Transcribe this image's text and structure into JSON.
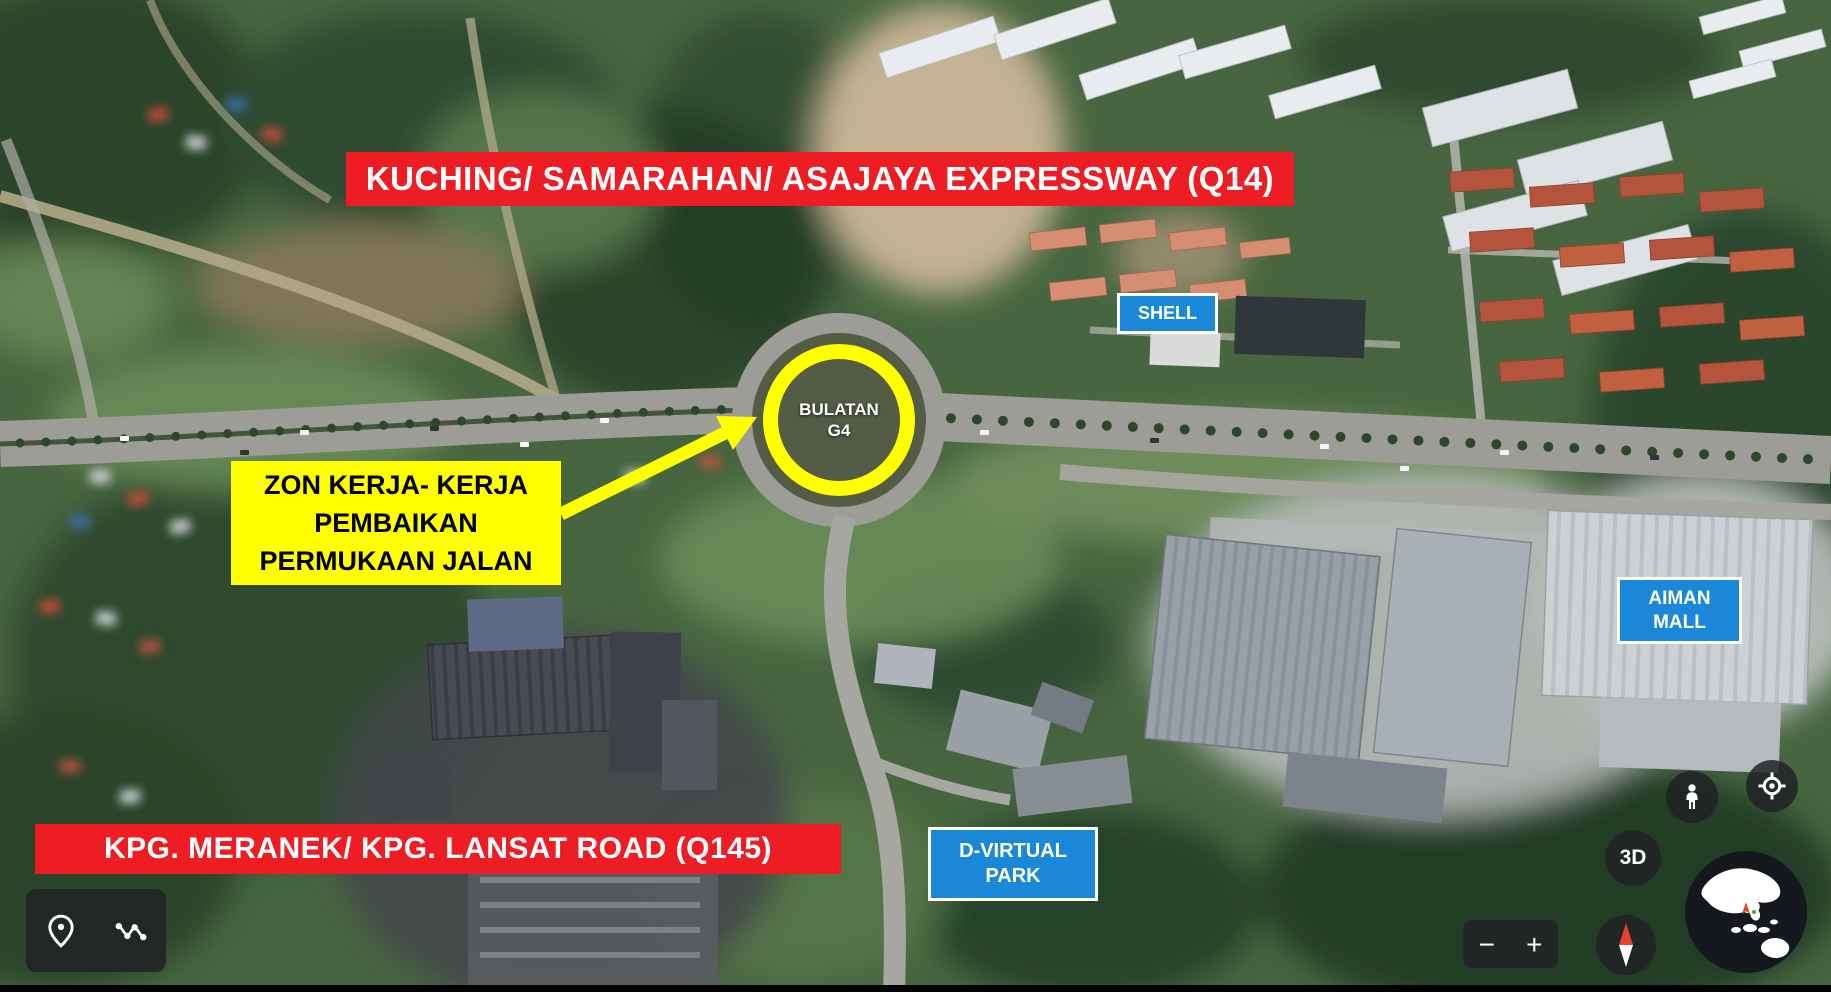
{
  "app": {
    "view": "satellite-map-with-roadwork-annotations"
  },
  "map_annotations": {
    "top_banner": "KUCHING/ SAMARAHAN/ ASAJAYA EXPRESSWAY (Q14)",
    "bottom_banner": "KPG. MERANEK/ KPG. LANSAT ROAD (Q145)",
    "work_zone_note": "ZON KERJA- KERJA\nPEMBAIKAN\nPERMUKAAN JALAN",
    "roundabout_label": "BULATAN\nG4",
    "place_labels": {
      "shell": "SHELL",
      "aiman_mall": "AIMAN\nMALL",
      "d_virtual_park": "D-VIRTUAL\nPARK"
    }
  },
  "controls": {
    "view_3d_label": "3D",
    "zoom": {
      "out_label": "−",
      "in_label": "+"
    },
    "icons": {
      "pin": "location-pin",
      "path": "measure-path",
      "pegman": "street-view-pegman",
      "my_location": "my-location-target",
      "compass": "compass-north-needle",
      "globe": "earth-globe"
    }
  },
  "colors": {
    "banner_red": "#ee1c23",
    "highlight_yellow": "#ffff00",
    "label_blue": "#1b87d9",
    "ui_dark": "#202124",
    "compass_north_red": "#e8402d"
  }
}
